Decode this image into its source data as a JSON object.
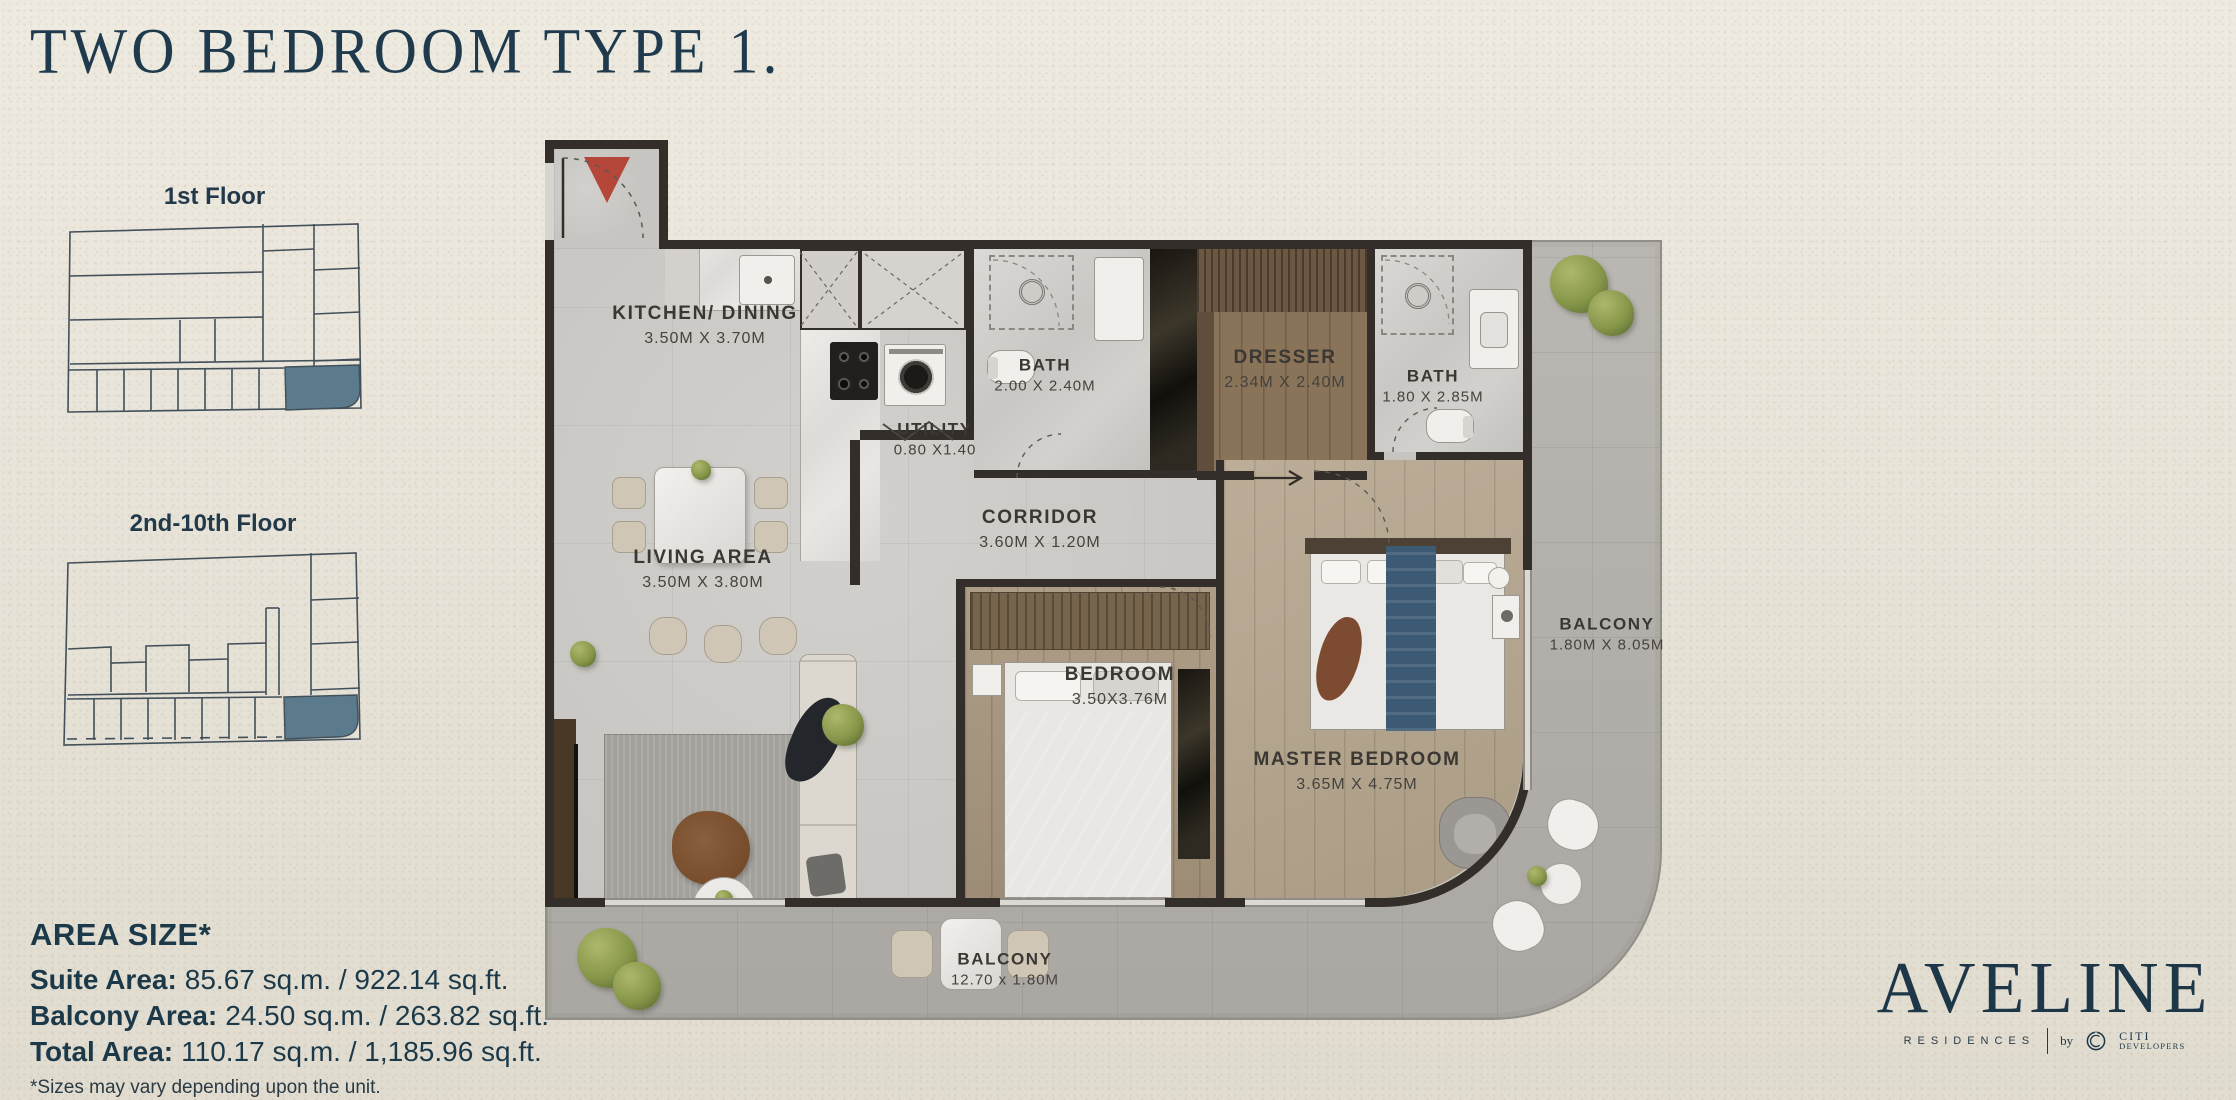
{
  "title": "TWO BEDROOM TYPE 1.",
  "floor_maps": {
    "first": {
      "label": "1st Floor"
    },
    "upper": {
      "label": "2nd-10th Floor"
    }
  },
  "rooms": {
    "kitchen_dining": {
      "name": "KITCHEN/ DINING",
      "dim": "3.50M X 3.70M"
    },
    "living_area": {
      "name": "LIVING AREA",
      "dim": "3.50M X 3.80M"
    },
    "utility": {
      "name": "UTILITY",
      "dim": "0.80 X1.40"
    },
    "bath_1": {
      "name": "BATH",
      "dim": "2.00 X 2.40M"
    },
    "corridor": {
      "name": "CORRIDOR",
      "dim": "3.60M X 1.20M"
    },
    "dresser": {
      "name": "DRESSER",
      "dim": "2.34M X 2.40M"
    },
    "bath_2": {
      "name": "BATH",
      "dim": "1.80 X 2.85M"
    },
    "bedroom": {
      "name": "BEDROOM",
      "dim": "3.50X3.76M"
    },
    "master_bedroom": {
      "name": "MASTER BEDROOM",
      "dim": "3.65M X 4.75M"
    },
    "balcony_side": {
      "name": "BALCONY",
      "dim": "1.80M X 8.05M"
    },
    "balcony_bottom": {
      "name": "BALCONY",
      "dim": "12.70 x 1.80M"
    }
  },
  "area_size": {
    "heading": "AREA SIZE*",
    "rows": [
      {
        "label": "Suite Area:",
        "value": "85.67 sq.m. / 922.14 sq.ft."
      },
      {
        "label": "Balcony Area:",
        "value": "24.50 sq.m. / 263.82 sq.ft."
      },
      {
        "label": "Total Area:",
        "value": "110.17 sq.m. / 1,185.96 sq.ft."
      }
    ],
    "footnote": "*Sizes may vary depending upon the unit."
  },
  "brand": {
    "wordmark": "AVELINE",
    "sub": "RESIDENCES",
    "by": "by",
    "developer_top": "CITI",
    "developer_bottom": "DEVELOPERS"
  },
  "colors": {
    "navy": "#1f3a4c",
    "wall": "#332e29",
    "unit_highlight": "#5b7b8d",
    "entry_arrow_red": "#b5473a",
    "background": "#e8e3d6"
  }
}
